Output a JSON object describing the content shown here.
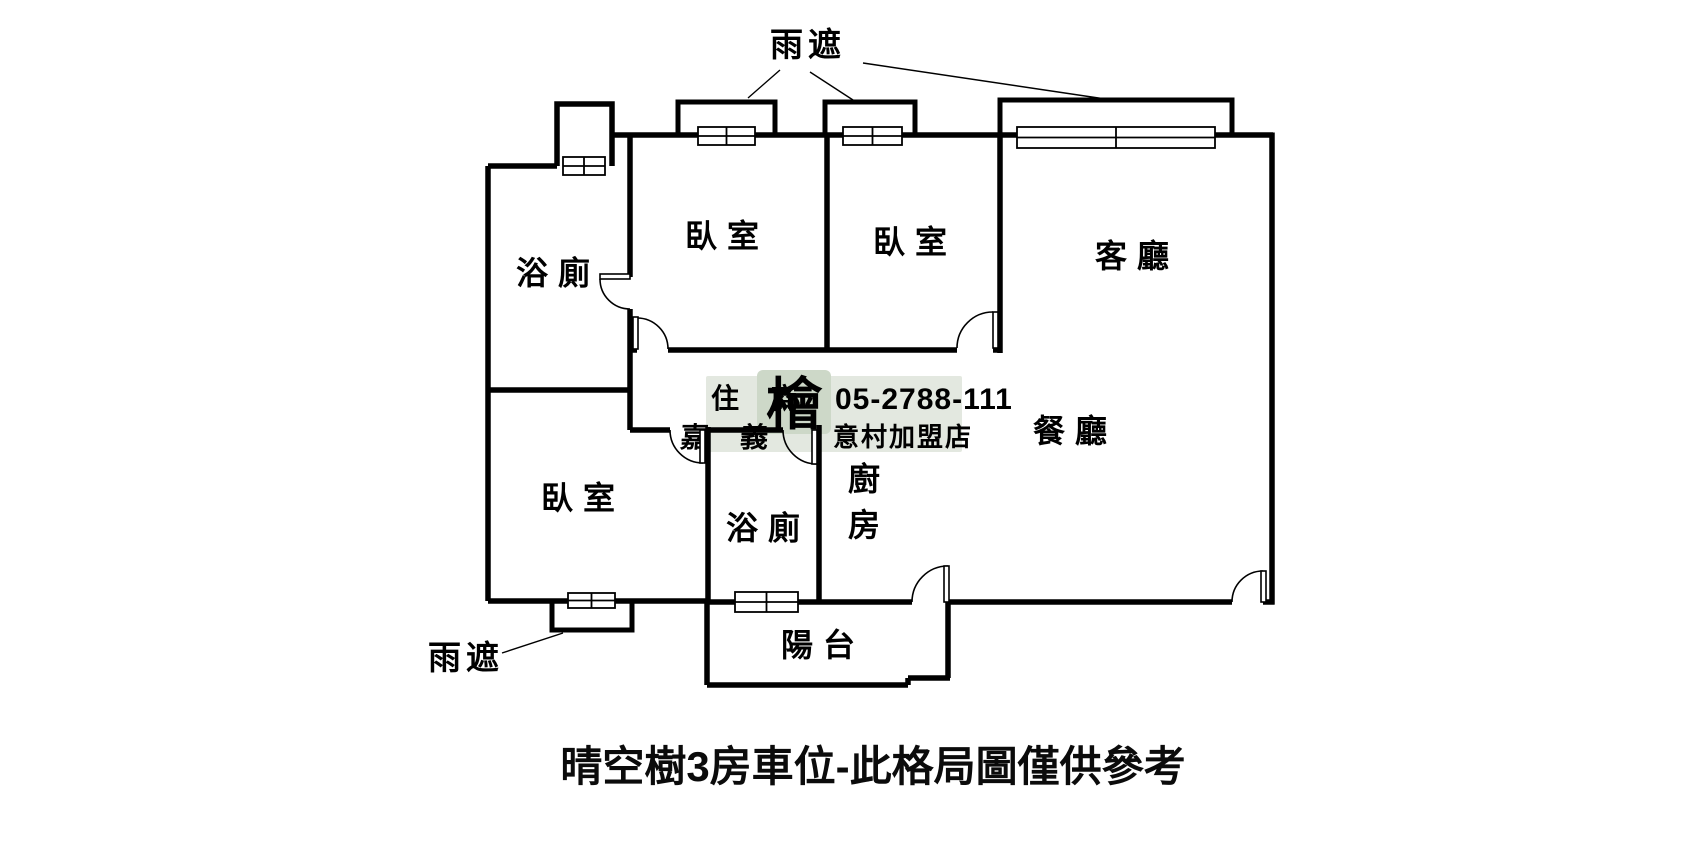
{
  "title": "晴空樹3房車位-此格局圖僅供參考",
  "rooms": {
    "bathroom_top": "浴廁",
    "bedroom_top_left": "臥室",
    "bedroom_top_right": "臥室",
    "living_room": "客廳",
    "dining_room": "餐廳",
    "bedroom_bottom": "臥室",
    "bathroom_bottom": "浴廁",
    "kitchen": "廚房",
    "balcony": "陽台"
  },
  "annotations": {
    "rain_shelter_top": "雨遮",
    "rain_shelter_bottom": "雨遮"
  },
  "watermark": {
    "brand_row1": "住 商",
    "brand_row2": "嘉 義",
    "logo_char": "檜",
    "phone": "05-2788-111",
    "store": "意村加盟店"
  },
  "colors": {
    "wall": "#000000",
    "background": "#ffffff",
    "watermark_bg": "#e3e8e0",
    "watermark_logo_bg": "#cdd8c8",
    "watermark_text": "#ffffff"
  }
}
